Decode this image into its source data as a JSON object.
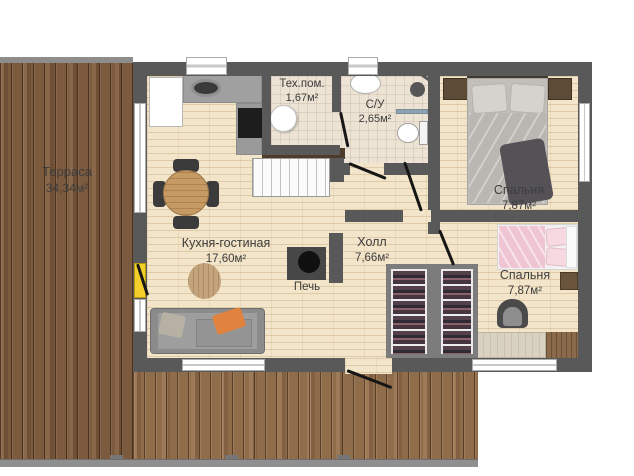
{
  "rooms": {
    "terrace": {
      "name": "Терраса",
      "area": "34,34м²"
    },
    "kitchen_living": {
      "name": "Кухня-гостиная",
      "area": "17,60м²"
    },
    "hall": {
      "name": "Холл",
      "area": "7,66м²"
    },
    "tech_room": {
      "name": "Тех.пом.",
      "area": "1,67м²"
    },
    "bathroom": {
      "name": "С/У",
      "area": "2,65м²"
    },
    "bedroom_top": {
      "name": "Спальня",
      "area": "7,87м²"
    },
    "bedroom_bottom": {
      "name": "Спальня",
      "area": "7,87м²"
    },
    "stove": {
      "name": "Печь"
    }
  },
  "colors": {
    "wall": "#595959",
    "interior_floor": "#f3e5c9",
    "terrace_wood": "#7b5a3e",
    "deck_wood": "#8f6c4a",
    "entry_door_accent": "#f2cf2a",
    "bed_pink": "#f0c5d3",
    "sofa_orange_pillow": "#e2823f"
  }
}
